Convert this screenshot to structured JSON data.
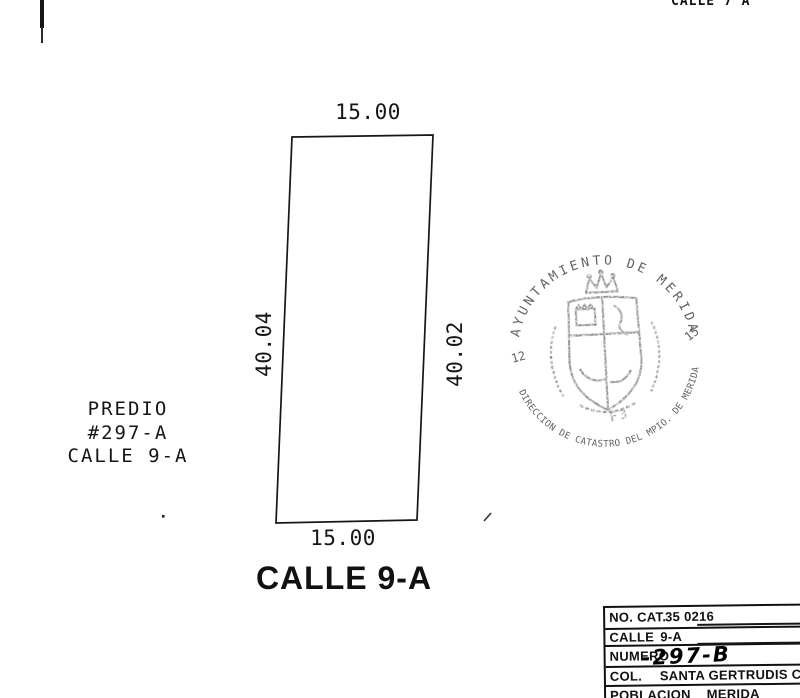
{
  "document": {
    "top_street_label": "CALLE 7 A",
    "parcel": {
      "dim_top": "15.00",
      "dim_bottom": "15.00",
      "dim_left": "40.04",
      "dim_right": "40.02"
    },
    "predio_label": {
      "line1": "PREDIO",
      "line2": "#297-A",
      "line3": "CALLE 9-A"
    },
    "street_label": "CALLE 9-A",
    "stamp": {
      "arc_top": "AYUNTAMIENTO DE MERIDA",
      "arc_bottom": "DIRECCION DE CATASTRO DEL MPIO. DE MERIDA",
      "number_left": "12",
      "number_right": "15",
      "code": "F3"
    },
    "info_table": {
      "rows": [
        {
          "label": "NO. CAT.",
          "value": "35 0216"
        },
        {
          "label": "CALLE",
          "value": "9-A"
        },
        {
          "label": "NUMERO",
          "value": "-297-B"
        },
        {
          "label": "COL.",
          "value": "SANTA GERTRUDIS CO"
        },
        {
          "label": "POBLACION",
          "value": "MERIDA"
        }
      ]
    },
    "colors": {
      "ink": "#1c1c1c",
      "stamp_ink": "#474747"
    }
  }
}
